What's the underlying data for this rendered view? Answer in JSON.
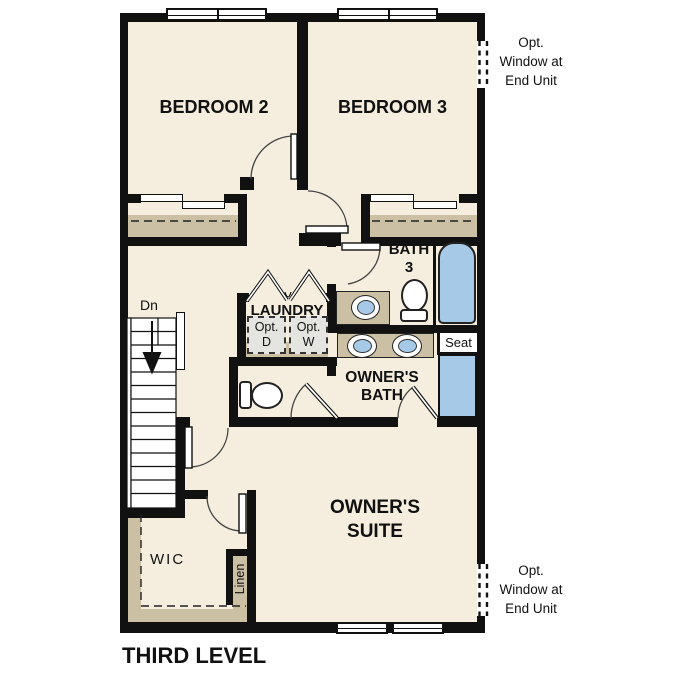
{
  "plan_title": "THIRD LEVEL",
  "rooms": {
    "bedroom2": "BEDROOM 2",
    "bedroom3": "BEDROOM 3",
    "bath3": [
      "BATH",
      "3"
    ],
    "laundry": "LAUNDRY",
    "owners_bath": [
      "OWNER'S",
      "BATH"
    ],
    "owners_suite": [
      "OWNER'S",
      "SUITE"
    ],
    "wic": "WIC",
    "linen": "Linen"
  },
  "labels": {
    "stairs_direction": "Dn",
    "shower_seat": "Seat",
    "opt_dryer": [
      "Opt.",
      "D"
    ],
    "opt_washer": [
      "Opt.",
      "W"
    ]
  },
  "annotations": {
    "opt_window_top": [
      "Opt.",
      "Window at",
      "End Unit"
    ],
    "opt_window_bottom": [
      "Opt.",
      "Window at",
      "End Unit"
    ]
  },
  "colors": {
    "floor": "#f5edde",
    "closet_shelf": "#cbbfa4",
    "fixture_blue": "#a7c9e8",
    "appliance_gray": "#e4e4e1",
    "wall": "#111111"
  }
}
